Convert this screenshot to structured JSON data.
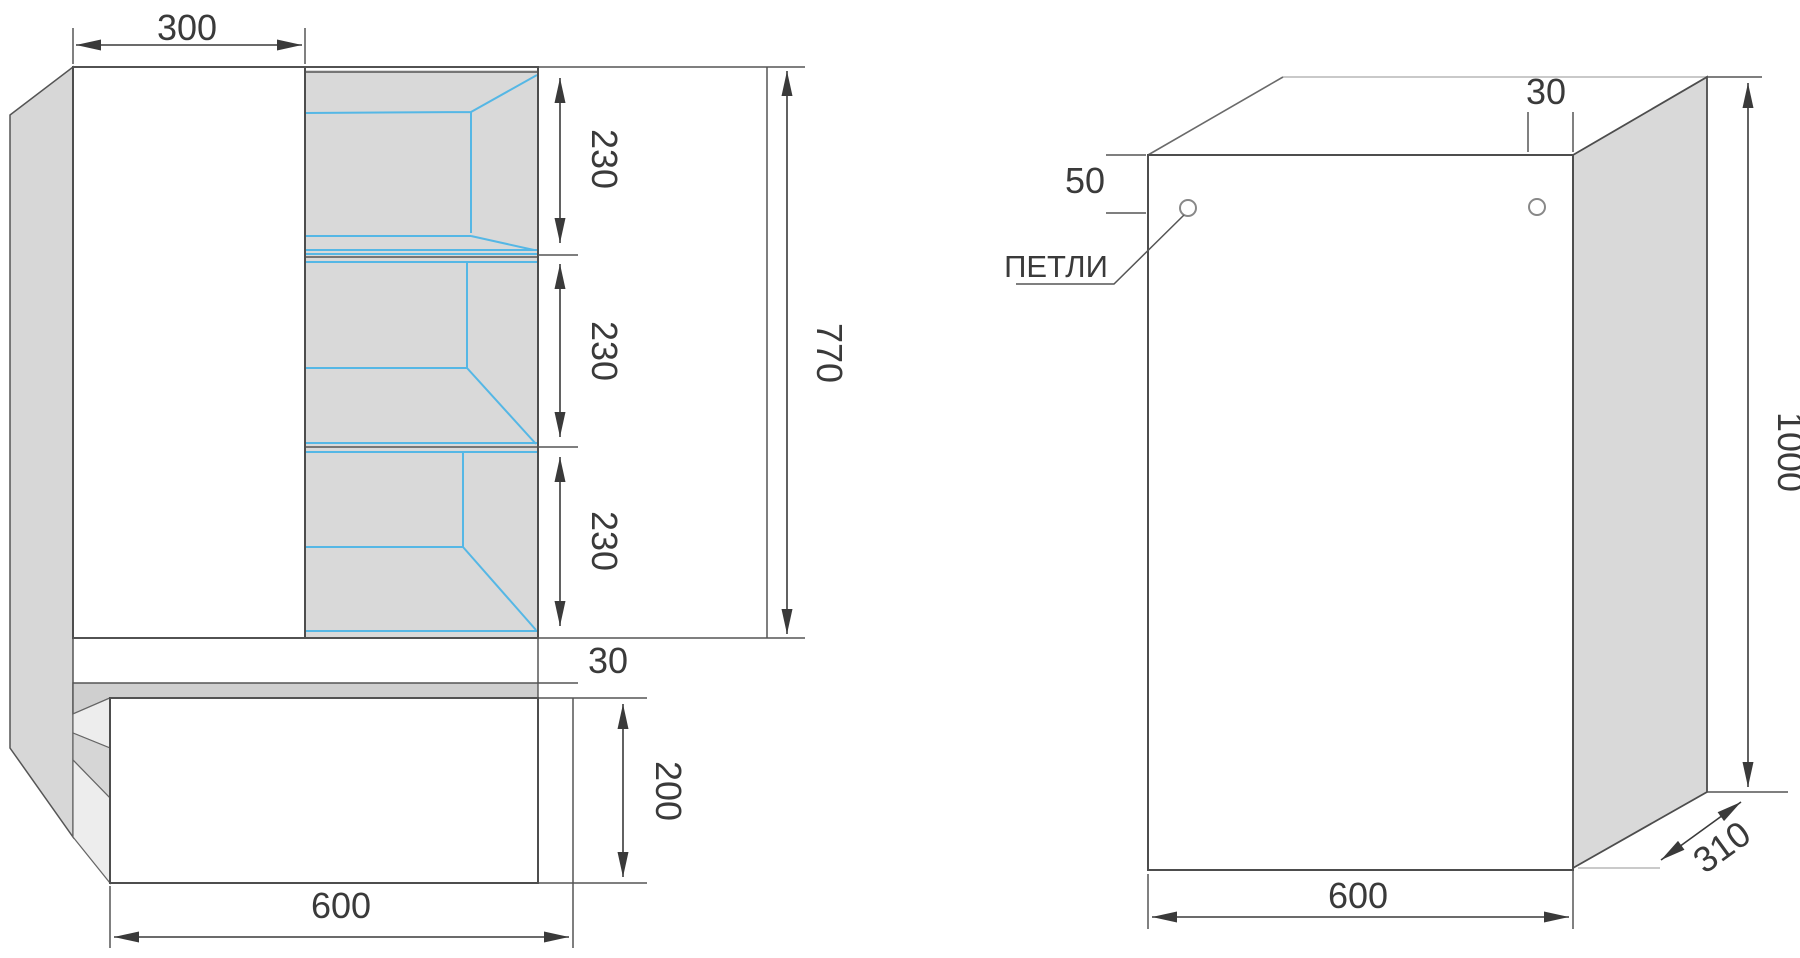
{
  "drawing": {
    "type": "furniture-technical-drawing",
    "views": [
      "front-elevation-with-shelves",
      "side-perspective-panel"
    ]
  },
  "colors": {
    "outline": "#4d4d4d",
    "panel_fill": "#d9d9d9",
    "side_panel_fill": "#d7d7d7",
    "counter_fill": "#cfcfcf",
    "wedge_light": "#ededed",
    "wedge_mid": "#d6d6d6",
    "interior_line": "#55b7e5",
    "dim_text": "#3a3a3a",
    "back_edge_light": "#c9c9c9"
  },
  "left_view": {
    "dims": {
      "door_width": "300",
      "shelf_1": "230",
      "shelf_2": "230",
      "shelf_3": "230",
      "upper_height": "770",
      "counter_gap": "30",
      "drawer_height": "200",
      "base_width": "600"
    }
  },
  "right_view": {
    "labels": {
      "hinges": "ПЕТЛИ"
    },
    "dims": {
      "hinge_top_offset": "50",
      "hinge_side_offset": "30",
      "height": "1000",
      "depth": "310",
      "width": "600"
    }
  }
}
